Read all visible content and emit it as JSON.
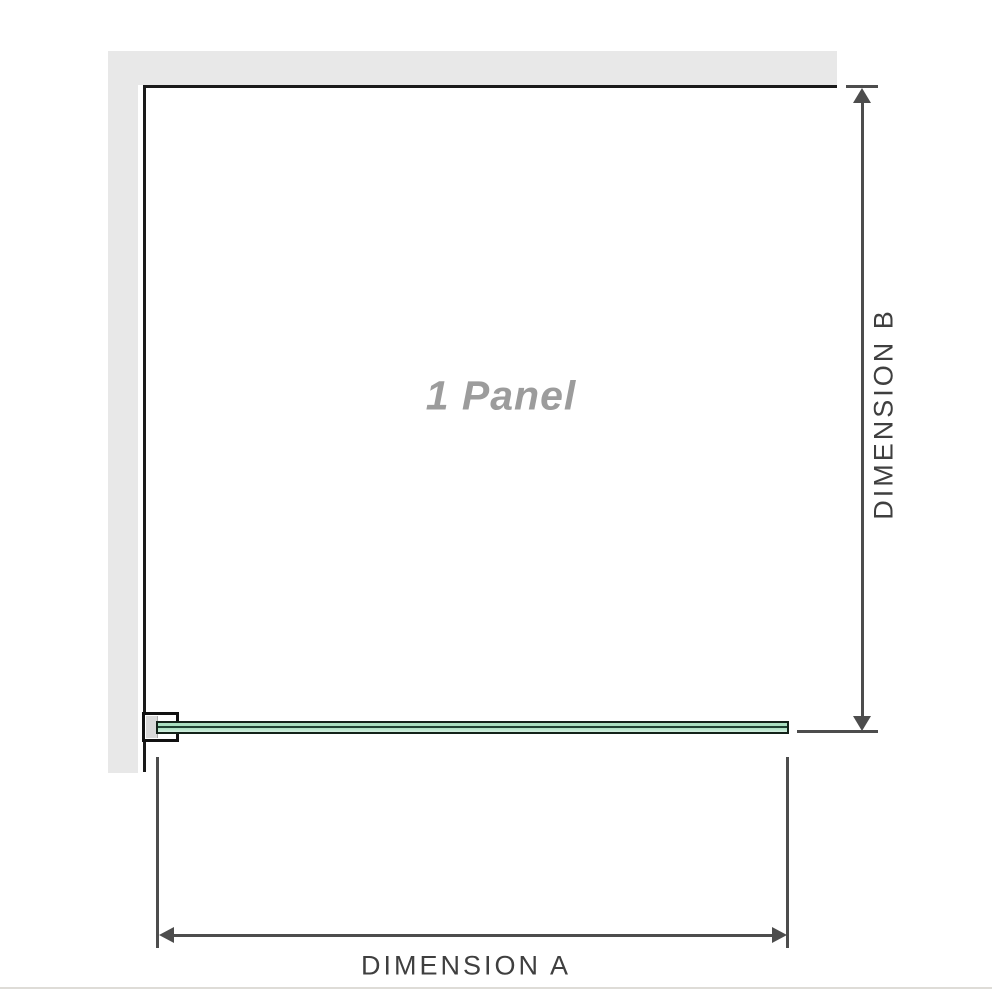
{
  "diagram": {
    "panel_label": "1 Panel",
    "dimension_a_label": "DIMENSION A",
    "dimension_b_label": "DIMENSION B"
  },
  "colors": {
    "wall_fill": "#e8e8e8",
    "panel_edge": "#1a1a1a",
    "dimension_line": "#4d4d4d",
    "dimension_text": "#3f3f3f",
    "panel_label_text": "#9c9c9c",
    "glass_fill_light": "#a9e0c0",
    "glass_fill_pale": "#d4f0e1",
    "glass_center_line": "#1d4231",
    "glass_border": "#132219",
    "image_edge": "#dedcd7"
  }
}
